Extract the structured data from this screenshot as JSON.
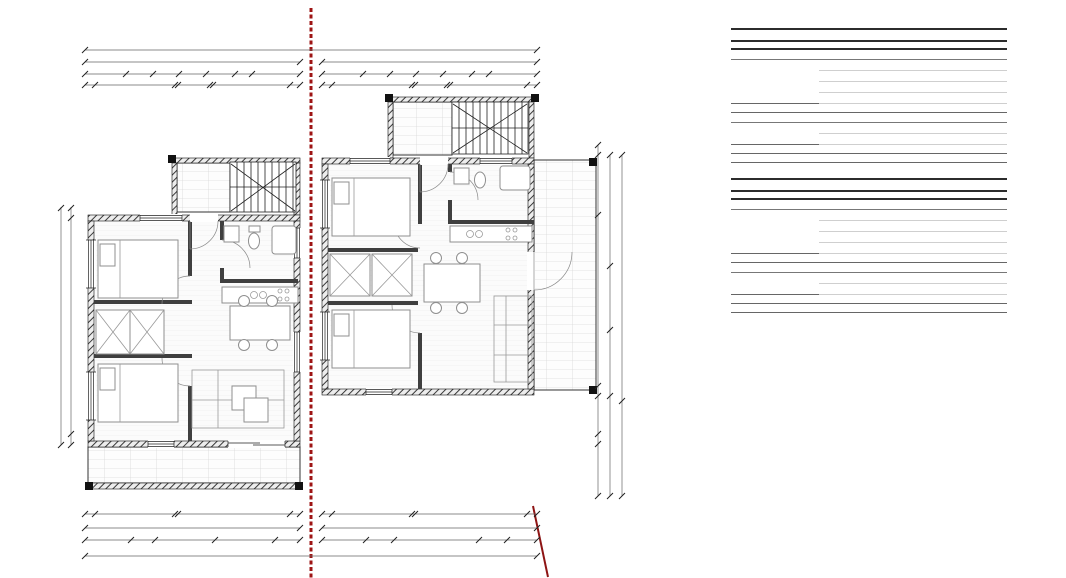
{
  "plan": {
    "title_a": "GRAĐEVINA A",
    "title_b": "GRAĐEVINA B",
    "boundary_label": "granica građevne čestice",
    "rooms_a": {
      "ulaz": {
        "name": "NATKRIVENI ULAZ/STUBIŠTE",
        "area": "P: 10,19 m²",
        "floor": "pod: ker.ploč."
      },
      "soba1": {
        "name": "SOBA 1",
        "area": "P: 9,84 m²",
        "floor": "pod: ker.ploč."
      },
      "kup": {
        "name": "KUP",
        "area": "P: 5,04 m²",
        "floor": "pod: ker.ploč."
      },
      "dnevna": {
        "name": "DNEVNA ZONA",
        "area": "P: 25,52 m²",
        "floor": "pod: ker.ploč."
      },
      "soba2": {
        "name": "SOBA 2",
        "area": "P: 9,84 m²",
        "floor": "pod: ker.ploč."
      },
      "terasa": {
        "name": "NATKRIVENA TERASA",
        "area": "P: 13,41 m²",
        "floor": "pod: ker.ploč."
      }
    },
    "rooms_b": {
      "ulaz": {
        "name": "NATKRIVENI ULAZ/STUBIŠTE",
        "area": "P: 10,19 m²",
        "floor": "pod: ker.ploč."
      },
      "soba1": {
        "name": "SOBA 1",
        "area": "P: 10,57 m²",
        "floor": "pod: laminat"
      },
      "kup": {
        "name": "KUP",
        "area": "P: 5,04 m²",
        "floor": "pod: ker.ploč."
      },
      "dnevna": {
        "name": "DNEVNA ZONA",
        "area": "P: 27,57 m²",
        "floor": "pod: laminat"
      },
      "soba2": {
        "name": "SOBA 2",
        "area": "P: 10,56 m²",
        "floor": "pod: laminat"
      },
      "terasa": {
        "name": "NATKRIVENA TERASA",
        "area": "P: 15,08 m²",
        "floor": "pod: ker.ploč."
      }
    },
    "dims": {
      "overall": "1,560",
      "total": "780",
      "top1": [
        "148",
        "100",
        "92",
        "100",
        "105",
        "60",
        "175"
      ],
      "top2": [
        "35",
        "290",
        "10",
        "120",
        "10",
        "280",
        "35"
      ],
      "bot1": [
        "35",
        "290",
        "10",
        "410",
        "35"
      ],
      "botA2": [
        "165",
        "90",
        "215",
        "220",
        "90"
      ],
      "botB2": [
        "160",
        "100",
        "310",
        "100",
        "110"
      ],
      "left": [
        "35",
        "730",
        "35"
      ],
      "left_total": "800",
      "right1": [
        "35",
        "190",
        "590",
        "35",
        "132",
        "35",
        "180"
      ],
      "right2": [
        "385",
        "220",
        "245",
        "347"
      ],
      "right3": [
        "850",
        "347"
      ]
    },
    "openings": {
      "p100": "p=100",
      "p0": "p=0",
      "d100_210": "100/210",
      "d100_215": "100/215",
      "d80_210": "80/210",
      "d90_210": "90/210",
      "d220_210": "220/210",
      "washer": "P"
    }
  },
  "tables": [
    {
      "title": "ISKAZ NETO POVRSINA: KUĆA A",
      "col_headers": [
        "pozicija",
        "prostorija",
        "površina"
      ],
      "sections": [
        {
          "label": "Unutarnji prostori",
          "rows": [
            [
              "DNEVNA ZONA",
              "25,52"
            ],
            [
              "KUP",
              "5,04"
            ],
            [
              "SOBA 1",
              "9,84"
            ],
            [
              "SOBA 2",
              "9,84"
            ]
          ],
          "subtotal": "50,24 m²"
        },
        {
          "label": "Vanjski prostori",
          "rows": [
            [
              "NATKRIVENA TERASA",
              "13,41"
            ],
            [
              "NATKRIVENI ULAZ/STUBIŠTE",
              "10,19"
            ]
          ],
          "subtotal": "23,60 m²"
        }
      ],
      "total": "73,84 m²"
    },
    {
      "title": "ISKAZ NETO POVRSINA: KUĆA B",
      "col_headers": [
        "pozicija",
        "prostorija",
        "površina"
      ],
      "sections": [
        {
          "label": "Unutarnji prostori",
          "rows": [
            [
              "DNEVNA ZONA",
              "27,57"
            ],
            [
              "KUP",
              "5,04"
            ],
            [
              "SOBA 1",
              "10,57"
            ],
            [
              "SOBA 2",
              "10,56"
            ]
          ],
          "subtotal": "53,74 m²"
        },
        {
          "label": "Vanjski prostori",
          "rows": [
            [
              "NATKRIVENA TERASA",
              "15,08"
            ],
            [
              "NATKRIVENI ULAZ/STUBIŠTE",
              "10,19"
            ]
          ],
          "subtotal": "25,27 m²"
        }
      ],
      "total": "79,01 m²"
    }
  ],
  "logo": {
    "brand": "MAiSON",
    "tagline": "REAL ESTATE"
  }
}
